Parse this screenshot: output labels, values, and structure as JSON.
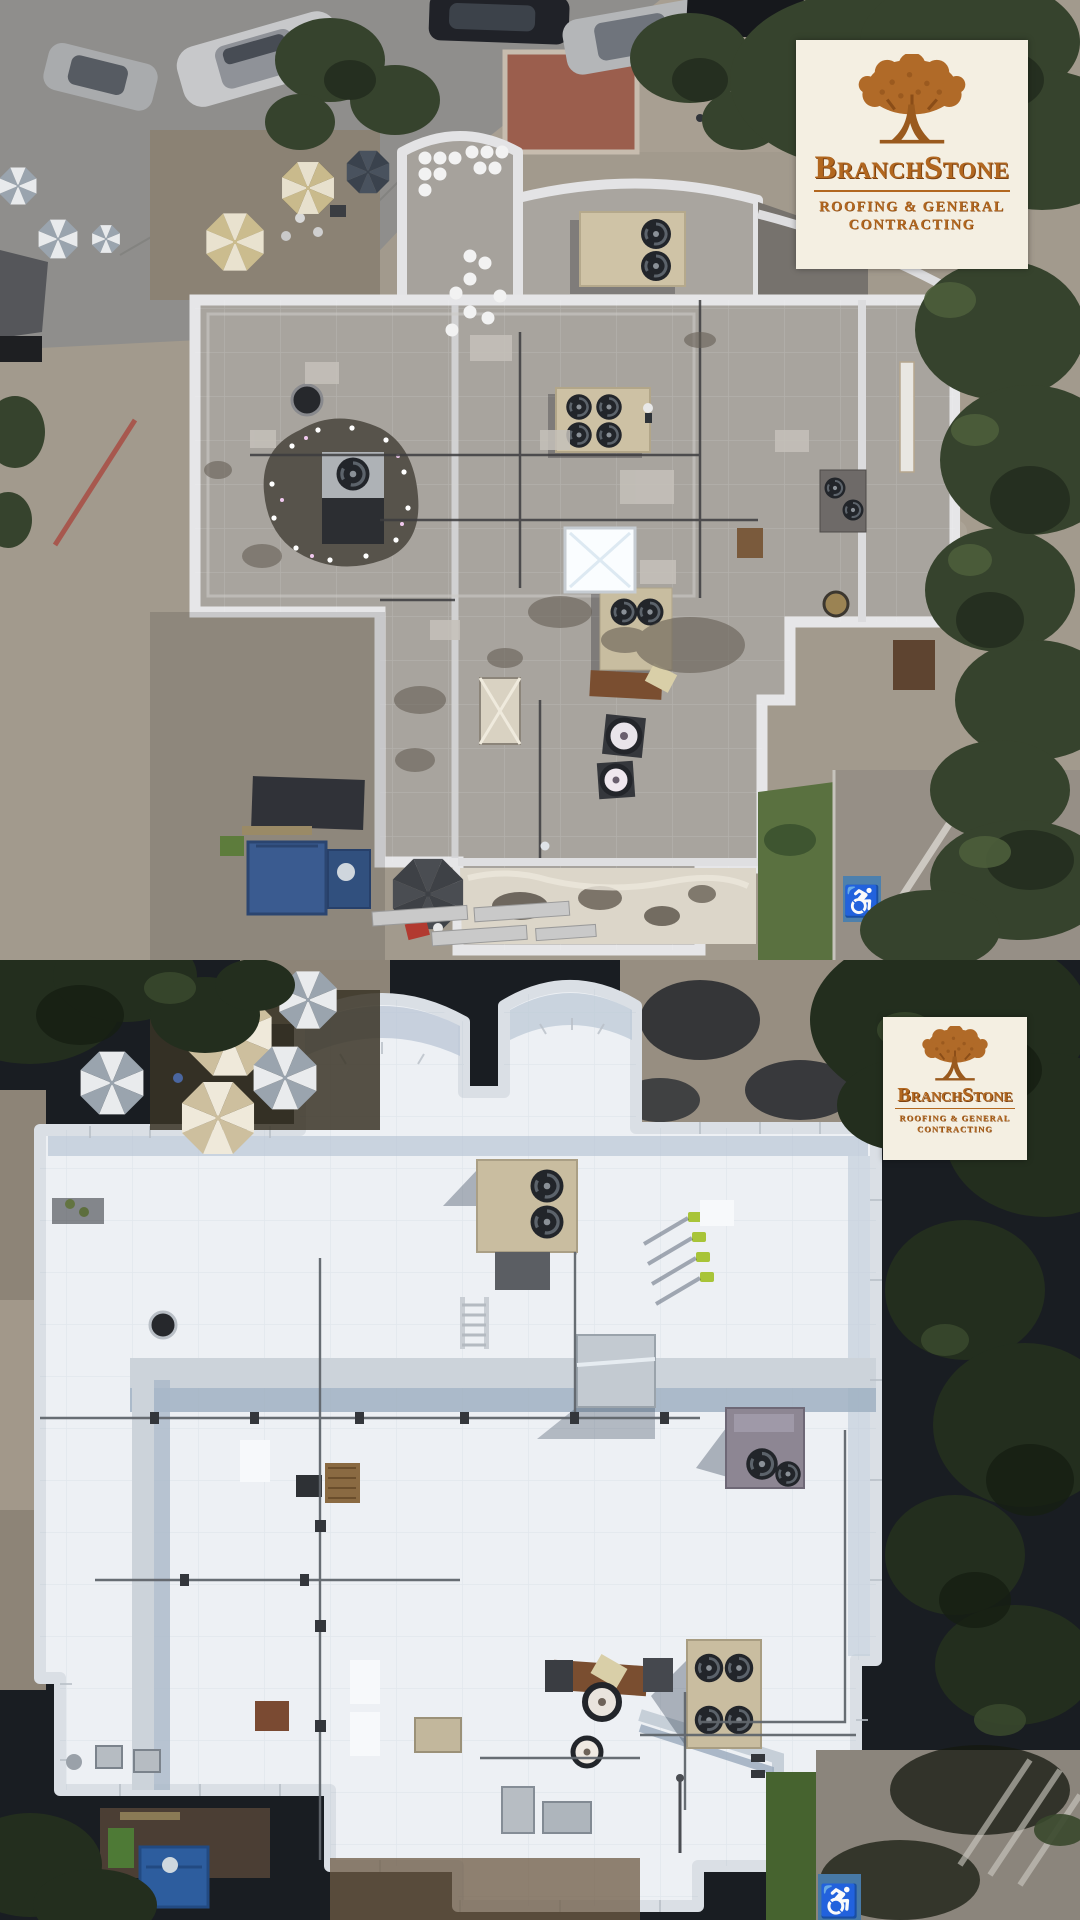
{
  "page": {
    "title": "Commercial roof restoration — before and after aerial drone photos"
  },
  "logo": {
    "name": "BranchStone",
    "tagline_line1": "ROOFING & GENERAL",
    "tagline_line2": "CONTRACTING",
    "icon": "oak-tree-icon",
    "colors": {
      "background": "#f4efe2",
      "copper": "#b2671f",
      "copper_dark": "#7d4212"
    }
  },
  "scenes": {
    "before": {
      "name": "aerial-before-gray-roof",
      "roof_color": "#a8a49e",
      "features": "weathered gray flat roof, rooftop HVAC units, ponding water, round vents, patio umbrellas, street with parked cars, blue dumpsters, foam roof section, accessible parking stall"
    },
    "after": {
      "name": "aerial-after-white-coated-roof",
      "roof_color": "#eef1f5",
      "features": "bright white coated flat roof, same building, HVAC units, conduit runs, striped patio umbrellas, tree shadows, blue dumpster, accessible parking stall"
    }
  },
  "pavement": {
    "accessible_symbol": "♿",
    "curb_text_line1": "TO GO",
    "curb_text_line2": "ONLY"
  }
}
